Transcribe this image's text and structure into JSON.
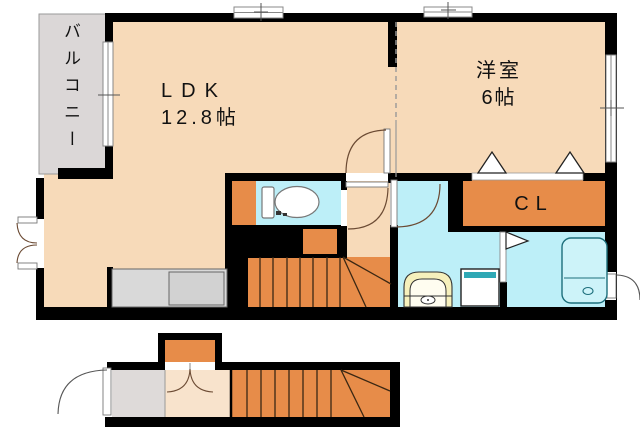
{
  "rooms": {
    "balcony": {
      "label": "バルコニー"
    },
    "ldk": {
      "name": "LDK",
      "size": "12.8帖"
    },
    "western_room": {
      "name": "洋室",
      "size": "6帖"
    },
    "closet": {
      "label": "CL"
    }
  },
  "fixtures": [
    "toilet",
    "toilet-cabinet",
    "vanity-sink",
    "washing-machine",
    "bathtub",
    "kitchen-counter",
    "staircase-upper",
    "staircase-lower",
    "stair-landing",
    "entrance-door",
    "balcony-window",
    "closet-sliding-door"
  ],
  "colors": {
    "wall": "#000000",
    "floor_room": "#F7DAB9",
    "floor_room_light": "#F8E3CC",
    "floor_wet": "#BDEFF8",
    "accent_orange": "#E78C49",
    "balcony_gray": "#DBD7D7",
    "counter_gray": "#D9D9D9",
    "vanity_yellow": "#F6F0BC",
    "washer_teal": "#2FA8B5",
    "tub_fill": "#CDF3F9",
    "tub_stroke": "#1D6F7C",
    "door_line": "#6B4A33",
    "stair_line": "#3A2713",
    "outline_gray": "#888888",
    "text": "#111111"
  }
}
